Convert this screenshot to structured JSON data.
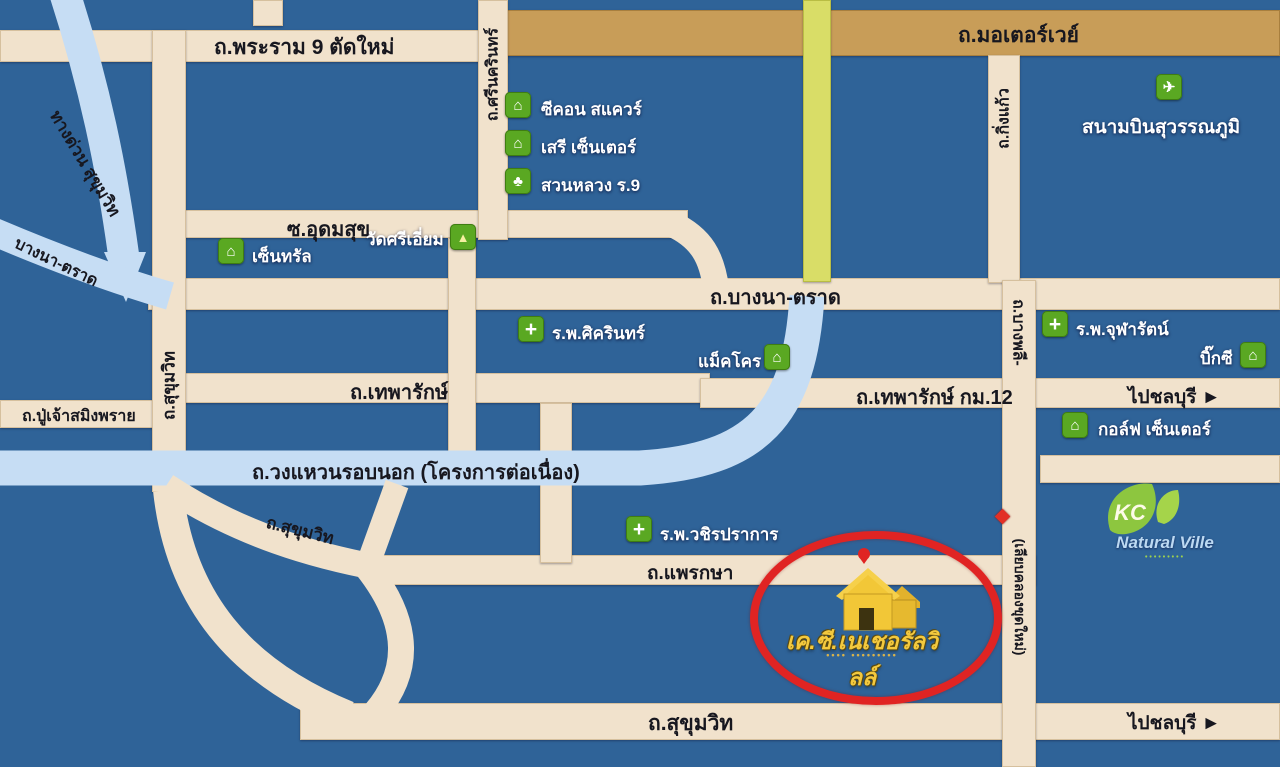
{
  "colors": {
    "background_blue": "#2f6398",
    "road_cream": "#f1e2cc",
    "motorway_tan": "#c89d58",
    "yellow_road": "#d9dd67",
    "expressway_blue": "#c6ddf4",
    "poi_icon_green": "#5aa822",
    "highlight_red": "#e02423",
    "house_yellow": "#f2c737",
    "script_gold": "#f3c93e"
  },
  "icons": {
    "mall": "⌂",
    "hospital": "+",
    "temple": "▲",
    "park": "♣",
    "airport": "✈"
  },
  "roads": {
    "rama9": "ถ.พระราม 9 ตัดใหม่",
    "motorway": "ถ.มอเตอร์เวย์",
    "srinakarin": "ถ.ศรีนครินทร์",
    "udomsuk": "ซ.อุดมสุข",
    "expressway": "ทางด่วน สุขุมวิท",
    "bangna_diag": "บางนา-ตราด",
    "bangna": "ถ.บางนา-ตราด",
    "sukhumvit_v": "ถ.สุขุมวิท",
    "theparak": "ถ.เทพารักษ์",
    "theparak_km12": "ถ.เทพารักษ์ กม.12",
    "puchao": "ถ.ปู่เจ้าสมิงพราย",
    "ringroad": "ถ.วงแหวนรอบนอก (โครงการต่อเนื่อง)",
    "sukhumvit_curve": "ถ.สุขุมวิท",
    "phraeksa": "ถ.แพรกษา",
    "sukhumvit_bottom": "ถ.สุขุมวิท",
    "kingkaeo": "ถ.กิ่งแก้ว",
    "bangphli": "ถ.บางพลี-",
    "canal": "(เลียบคลองขุดใหม่)",
    "to_chonburi": "ไปชลบุรี",
    "arrow_right": "►"
  },
  "pois": {
    "seacon": {
      "label": "ซีคอน สแควร์"
    },
    "seri": {
      "label": "เสรี เซ็นเตอร์"
    },
    "suanluang": {
      "label": "สวนหลวง ร.9"
    },
    "central": {
      "label": "เซ็นทรัล"
    },
    "wat_sri_iam": {
      "label": "วัดศรีเอี่ยม"
    },
    "sikarin": {
      "label": "ร.พ.ศิครินทร์"
    },
    "makro": {
      "label": "แม็คโคร"
    },
    "chularat": {
      "label": "ร.พ.จุฬารัตน์"
    },
    "bigc": {
      "label": "บิ๊กซี"
    },
    "golf_center": {
      "label": "กอล์ฟ เซ็นเตอร์"
    },
    "airport": {
      "label": "สนามบินสุวรรณภูมิ"
    },
    "wachiraprakan": {
      "label": "ร.พ.วชิรปราการ"
    }
  },
  "site": {
    "name": "เค.ซี.เนเชอรัลวิลล์",
    "subtitle": "•••• •••••••••"
  },
  "logo": {
    "initials": "KC",
    "name": "Natural Ville",
    "tagline": "•••••••••"
  }
}
